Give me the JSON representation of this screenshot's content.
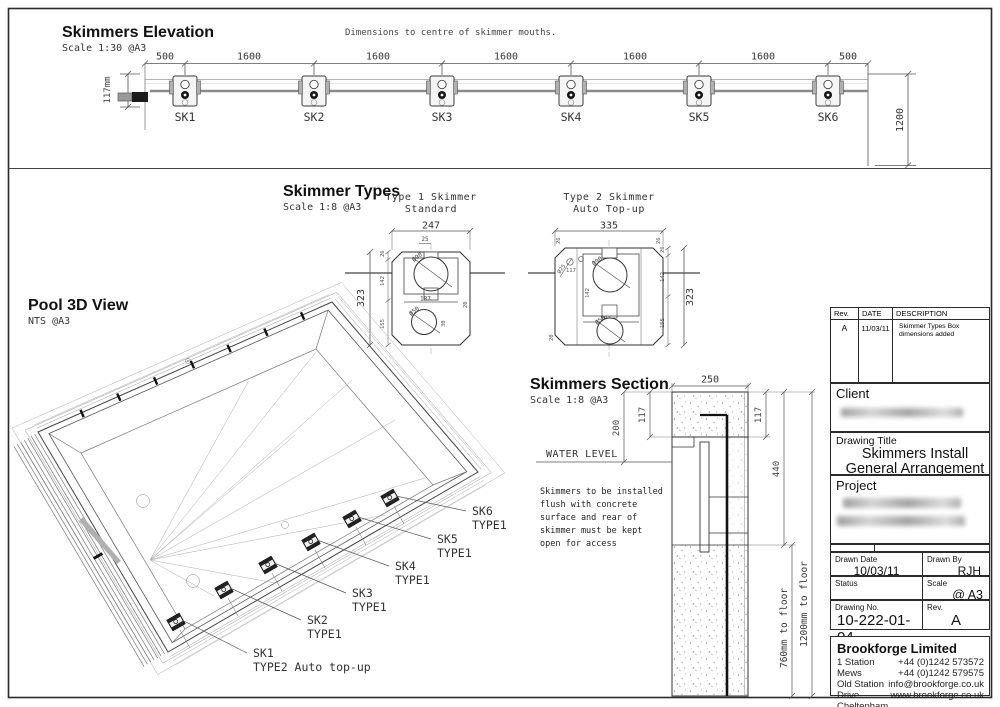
{
  "elevation": {
    "title": "Skimmers Elevation",
    "scale": "Scale 1:30 @A3",
    "note": "Dimensions to centre of skimmer mouths.",
    "top_dims": [
      "500",
      "1600",
      "1600",
      "1600",
      "1600",
      "1600",
      "500"
    ],
    "left_dim": "117mm",
    "right_dim": "1200",
    "skimmer_labels": [
      "SK1",
      "SK2",
      "SK3",
      "SK4",
      "SK5",
      "SK6"
    ]
  },
  "types": {
    "title": "Skimmer Types",
    "scale": "Scale 1:8 @A3",
    "type1": {
      "name1": "Type 1 Skimmer",
      "name2": "Standard",
      "width": "247",
      "height": "323",
      "top_offset": "25",
      "seg1": "26",
      "seg2": "142",
      "seg3": "155",
      "inner_width": "187",
      "side": "20",
      "mouth_dia": "Ø90",
      "drain_dia": "Ø50",
      "drain_offset": "30"
    },
    "type2": {
      "name1": "Type 2 Skimmer",
      "name2": "Auto Top-up",
      "width": "335",
      "height": "323",
      "corner_left": "26",
      "corner_right": "26",
      "seg1": "26",
      "seg2": "142",
      "seg3": "155",
      "inner_height": "142",
      "inner_width": "187",
      "side": "20",
      "float_dia": "Ø25",
      "mouth_dia": "Ø90",
      "drain_dia": "Ø50",
      "mouth_height": "117"
    }
  },
  "pool3d": {
    "title": "Pool 3D View",
    "scale": "NTS @A3",
    "labels": [
      {
        "id": "SK6",
        "type": "TYPE1"
      },
      {
        "id": "SK5",
        "type": "TYPE1"
      },
      {
        "id": "SK4",
        "type": "TYPE1"
      },
      {
        "id": "SK3",
        "type": "TYPE1"
      },
      {
        "id": "SK2",
        "type": "TYPE1"
      },
      {
        "id": "SK1",
        "type": "TYPE2 Auto top-up"
      }
    ]
  },
  "section": {
    "title": "Skimmers Section",
    "scale": "Scale 1:8 @A3",
    "water_level": "WATER LEVEL",
    "width": "250",
    "lip_left": "117",
    "lip_right": "117",
    "to_water": "200",
    "to_skimmer_bottom": "440",
    "floor_a": "760mm to floor",
    "floor_b": "1200mm to floor",
    "note": [
      "Skimmers to be installed",
      "flush with concrete",
      "surface and rear of",
      "skimmer must be kept",
      "open for access"
    ]
  },
  "title_block": {
    "rev_header": {
      "rev": "Rev.",
      "date": "DATE",
      "description": "DESCRIPTION"
    },
    "rev_row": {
      "rev": "A",
      "date": "11/03/11",
      "description": "Skimmer Types Box dimensions added"
    },
    "client_label": "Client",
    "drawing_title_label": "Drawing Title",
    "drawing_title": [
      "Skimmers Install",
      "General Arrangement"
    ],
    "project_label": "Project",
    "drawn_date_label": "Drawn Date",
    "drawn_date": "10/03/11",
    "drawn_by_label": "Drawn By",
    "drawn_by": "RJH",
    "status_label": "Status",
    "scale_label": "Scale",
    "scale": "@ A3",
    "drawing_no_label": "Drawing No.",
    "drawing_no": "10-222-01-04",
    "rev_label": "Rev.",
    "rev": "A",
    "company": {
      "name": "Brookforge Limited",
      "address": [
        "1 Station Mews",
        "Old Station Drive",
        "Cheltenham",
        "GL53 0DL"
      ],
      "contacts": [
        "+44 (0)1242 573572",
        "+44 (0)1242 579575",
        "info@brookforge.co.uk",
        "www.brookforge.co.uk"
      ]
    }
  }
}
